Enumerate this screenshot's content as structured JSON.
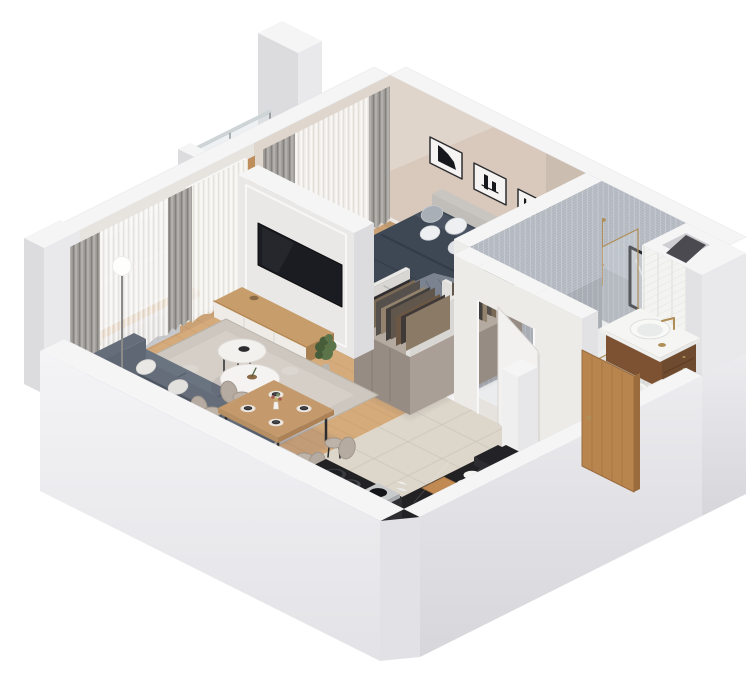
{
  "background": "#ffffff",
  "palette": {
    "wallTop": "#f5f5f6",
    "wallFace": "#e9e9eb",
    "wallFaceDark": "#dcdcdf",
    "nwWall": "#e7e4e0",
    "bedroomWall": "#d8c9bc",
    "bedroomWallDark": "#c9b9ab",
    "mosaic": "#b2b7bf",
    "whiteTile": "#f3f3f1",
    "tileLine": "#e2e2de",
    "woodFloor": "#d5ab7c",
    "plankLine": "#b9905f",
    "tileFloor": "#ddd6cb",
    "grout": "#c8c1b5",
    "marbleFloor": "#ebeced",
    "marbleLine": "#dcdde1",
    "curtainGray": "#a5a29d",
    "curtainSheer": "#f2f0ec",
    "glass": "#dce3e7",
    "brass": "#b08d57",
    "tv": "#1a1c21",
    "standWood": "#c79d6b",
    "standWoodDark": "#a87f50",
    "drawerWhite": "#efece8",
    "sofa": "#5e6773",
    "sofaDark": "#4e5661",
    "sofaSeat": "#6a7380",
    "rug": "#cdc7bf",
    "rugLight": "#dad4cc",
    "tableWood": "#c49a6c",
    "tableWoodDark": "#ab8155",
    "chair": "#b6aba0",
    "chairDark": "#a1968b",
    "bedBase": "#e9e7e3",
    "duvet": "#3e4754",
    "duvetDark": "#323a47",
    "duvetFold": "#4b5462",
    "pillowWhite": "#edeff1",
    "pillowGray": "#a9afb7",
    "throwColor": "#7b8390",
    "throwDark": "#6b7380",
    "wardrobe": "#a99f96",
    "wardrobeDark": "#968c83",
    "wardrobeTop": "#b4aaa0",
    "counter": "#222225",
    "vanityWood": "#85593a",
    "vanityWoodDark": "#6e4a2f",
    "fixtureWhite": "#f6f6f4",
    "doorWood": "#b9854f",
    "doorWoodDark": "#9a6c3d",
    "plantGreen": "#5c7449",
    "plantDark": "#475c39",
    "black": "#17181b"
  },
  "clothes_palette": [
    "#6b5744",
    "#3f3a37",
    "#8a7a66",
    "#2f2d2f",
    "#7a6a55",
    "#55504b",
    "#93836e",
    "#423e3b",
    "#60564b"
  ],
  "scene": {
    "type": "isometric-3d-floor-plan-render",
    "rooms": [
      {
        "name": "floors",
        "items": [
          "wood-floor",
          "hall-tile-floor",
          "kitchen-tile-floor",
          "bathroom-marble-floor"
        ]
      },
      {
        "name": "balcony",
        "items": [
          "balcony-floor",
          "divider-wall",
          "glass-railing"
        ]
      },
      {
        "name": "window-wall",
        "items": [
          "window",
          "radiator",
          "window-sill",
          "balcony-door",
          "curtains",
          "sheer-curtains"
        ]
      },
      {
        "name": "bedroom-wall",
        "items": [
          "wall-art-1",
          "wall-art-2",
          "wall-art-3"
        ]
      },
      {
        "name": "bathroom-wall",
        "items": [
          "mosaic-tile-wall",
          "white-tile-wall",
          "wall-sconce",
          "shower-fixture",
          "mirror",
          "vent-shaft"
        ]
      },
      {
        "name": "bathroom",
        "items": [
          "shower-tray",
          "shower-glass",
          "vanity",
          "sink",
          "toilet"
        ]
      },
      {
        "name": "bedroom",
        "items": [
          "double-bed",
          "pillows",
          "duvet",
          "throw-blanket",
          "clothes-rack"
        ]
      },
      {
        "name": "partitions",
        "items": [
          "bedroom-bathroom-wall"
        ]
      },
      {
        "name": "hallway",
        "items": [
          "wardrobe",
          "clothes-rail",
          "bathroom-door",
          "doormat"
        ]
      },
      {
        "name": "tv-area",
        "items": [
          "tv-partition",
          "tv",
          "tv-stand",
          "potted-plant"
        ]
      },
      {
        "name": "living-room",
        "items": [
          "area-rug",
          "sofa",
          "sofa-pillows",
          "coffee-tables",
          "floor-lamp"
        ]
      },
      {
        "name": "dining-area",
        "items": [
          "dining-table",
          "dining-chairs",
          "place-settings",
          "flower-vase"
        ]
      },
      {
        "name": "kitchen",
        "items": [
          "black-counter",
          "cooktop",
          "pots",
          "cutting-board",
          "dishes"
        ]
      },
      {
        "name": "front-walls",
        "items": [
          "low-wall-left",
          "low-wall-right",
          "corner-column"
        ]
      },
      {
        "name": "entrance",
        "items": [
          "entrance-door"
        ]
      }
    ]
  }
}
